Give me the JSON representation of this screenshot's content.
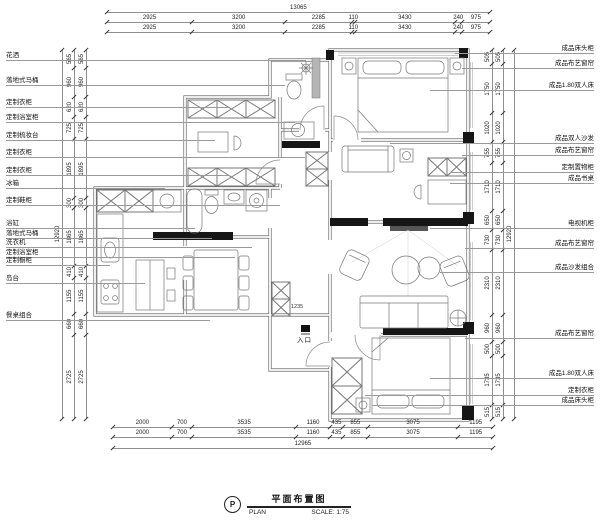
{
  "drawing": {
    "symbol_letter": "P",
    "title_cn": "平面布置图",
    "title_en": "PLAN",
    "scale_label": "SCALE: 1:75",
    "entrance_label": "入口"
  },
  "dimensions": {
    "top_total": [
      "13065"
    ],
    "top_row1": [
      "2925",
      "3200",
      "2285",
      "110",
      "3430",
      "240",
      "975"
    ],
    "top_row2": [
      "2925",
      "3200",
      "2285",
      "110",
      "3430",
      "240",
      "975"
    ],
    "bottom_row1": [
      "2000",
      "700",
      "3535",
      "1160",
      "435",
      "855",
      "3075",
      "1195"
    ],
    "bottom_row2": [
      "2000",
      "700",
      "3535",
      "1160",
      "435",
      "855",
      "3075",
      "1195"
    ],
    "bottom_total": [
      "12965"
    ],
    "left_col1": [
      "565",
      "960",
      "620",
      "725",
      "1895",
      "300",
      "1865",
      "410",
      "1155",
      "660",
      "2725"
    ],
    "left_col2": [
      "565",
      "960",
      "620",
      "725",
      "1895",
      "300",
      "1865",
      "410",
      "1155",
      "660",
      "2725"
    ],
    "left_total": [
      "12920"
    ],
    "right_col1": [
      "505",
      "1750",
      "1020",
      "755",
      "1710",
      "650",
      "730",
      "2310",
      "960",
      "500",
      "1735",
      "515"
    ],
    "right_col2": [
      "505",
      "1750",
      "1020",
      "755",
      "1710",
      "650",
      "730",
      "2310",
      "960",
      "500",
      "1735",
      "515"
    ],
    "right_total": [
      "12920"
    ],
    "entry_inner": "1235"
  },
  "labels_left": [
    "花洒",
    "落地式马桶",
    "定制衣柜",
    "定制浴室柜",
    "定制梳妆台",
    "定制衣柜",
    "定制衣柜",
    "冰箱",
    "定制鞋柜",
    "浴缸",
    "落地式马桶",
    "洗衣机",
    "定制浴室柜",
    "定制橱柜",
    "岛台",
    "餐桌组合"
  ],
  "labels_right": [
    "成品床头柜",
    "成品布艺窗帘",
    "成品1.80双人床",
    "成品双人沙发",
    "成品布艺窗帘",
    "定制置物柜",
    "成品书桌",
    "电视机柜",
    "成品布艺窗帘",
    "成品沙发组合",
    "成品布艺窗帘",
    "成品1.80双人床",
    "定制衣柜",
    "成品床头柜"
  ]
}
